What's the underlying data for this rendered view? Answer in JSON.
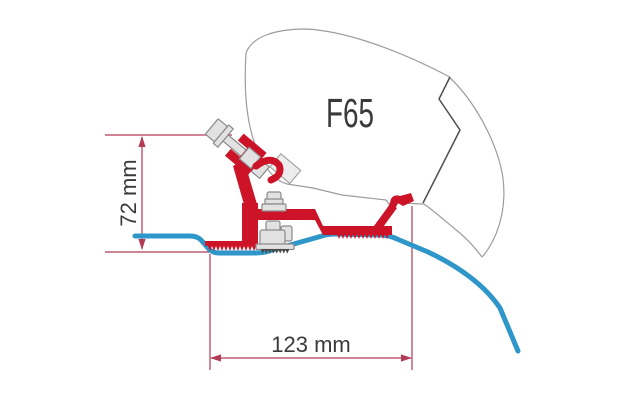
{
  "diagram": {
    "product_label": "F65",
    "height_dimension": "72 mm",
    "width_dimension": "123 mm"
  },
  "colors": {
    "background": "#ffffff",
    "bracket-red": "#cd1327",
    "dimension-red": "#b23b56",
    "roof-blue": "#2e96c8",
    "outline-gray": "#9c9c9c",
    "outline-dark": "#4f4f4f",
    "metal-fill": "#e2e2e2",
    "metal-stroke": "#8a8a8a",
    "label-color": "#3a3a3a"
  }
}
